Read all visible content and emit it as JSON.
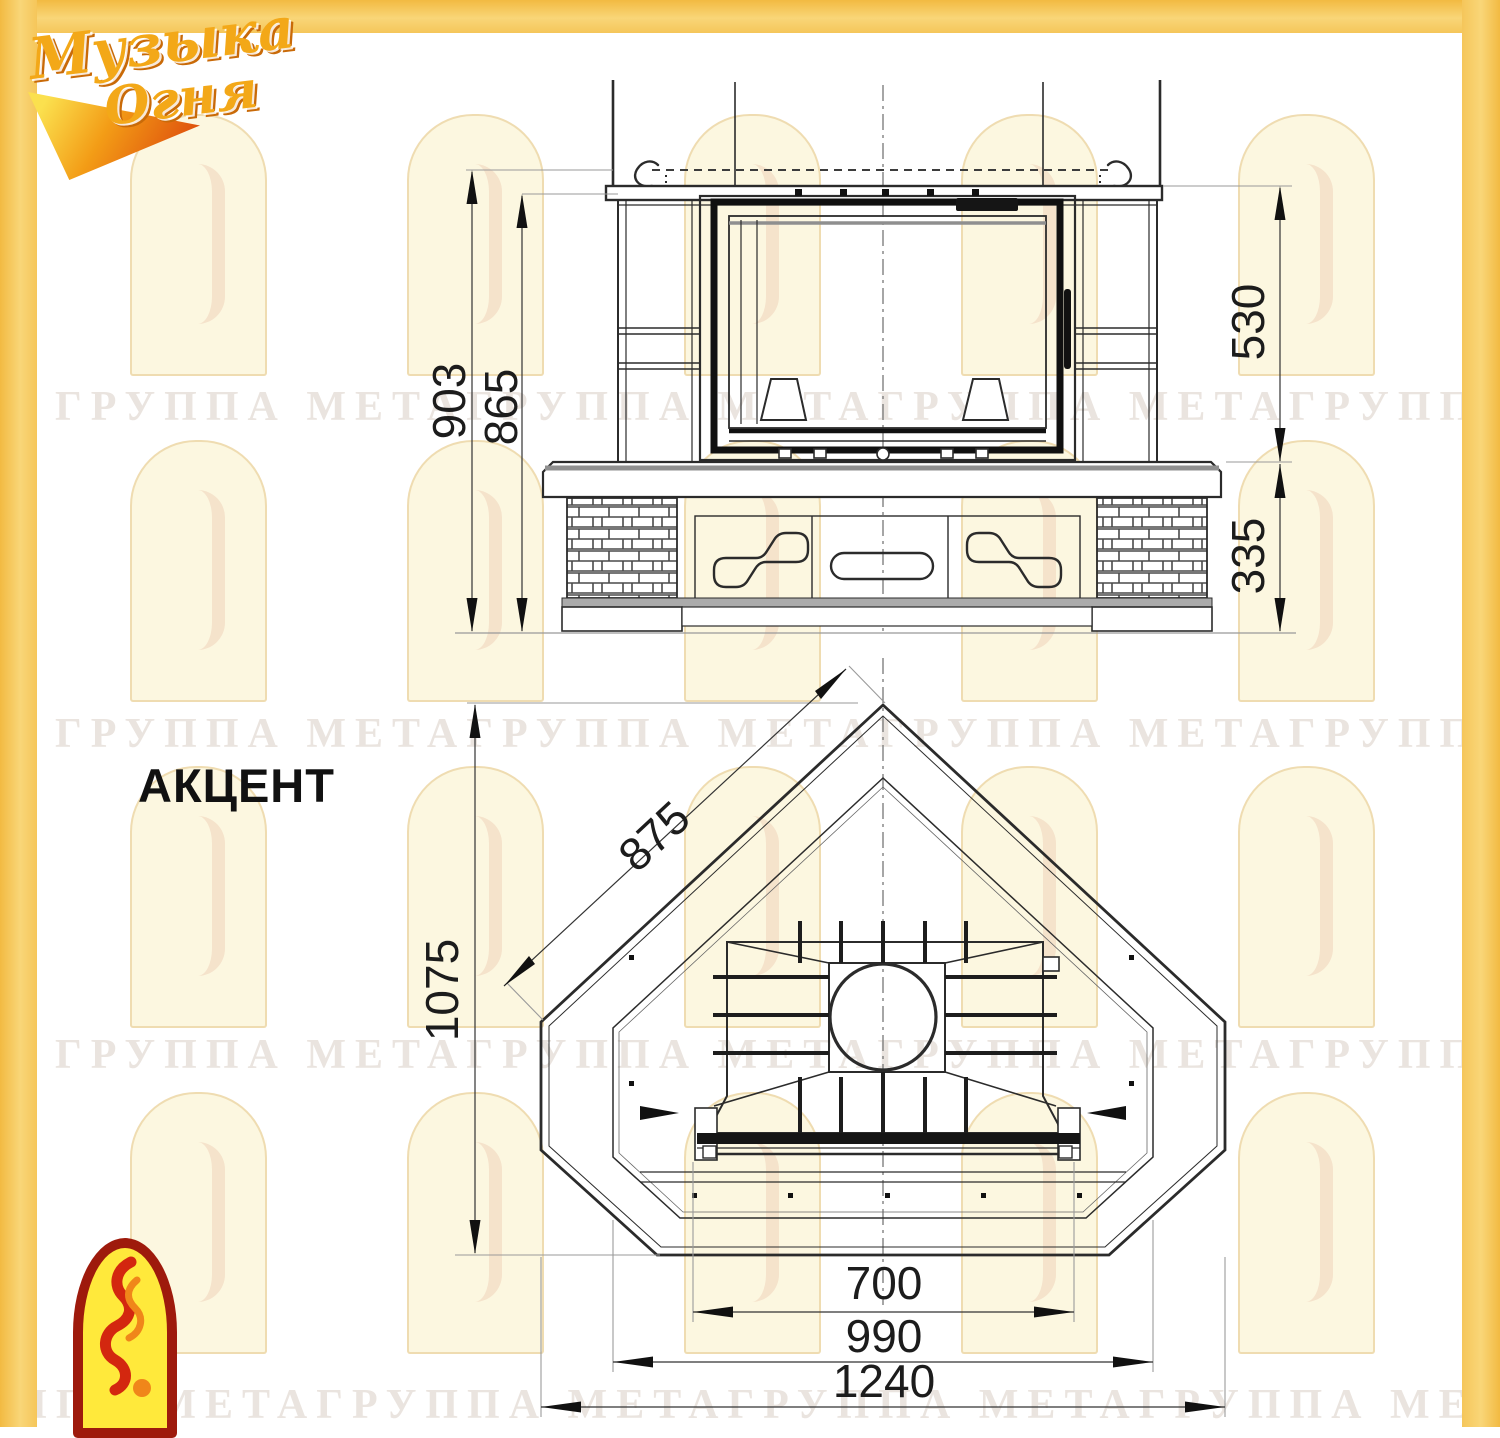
{
  "page": {
    "background": "#ffffff",
    "frame_color": "#F5C65A"
  },
  "brand_logo": {
    "line1": "Музыка",
    "line2": "Огня"
  },
  "title": "АКЦЕНТ",
  "watermark": {
    "text": "ГРУППА МЕТАГРУППА МЕТАГРУППА МЕТАГРУППА МЕТА"
  },
  "front_view": {
    "dims": {
      "total_height": "903",
      "mantel_height": "865",
      "firebox_height": "530",
      "base_height": "335"
    }
  },
  "plan_view": {
    "dims": {
      "side_width": "875",
      "depth": "1075",
      "front_width": "700",
      "mid_width": "990",
      "total_width": "1240"
    }
  }
}
